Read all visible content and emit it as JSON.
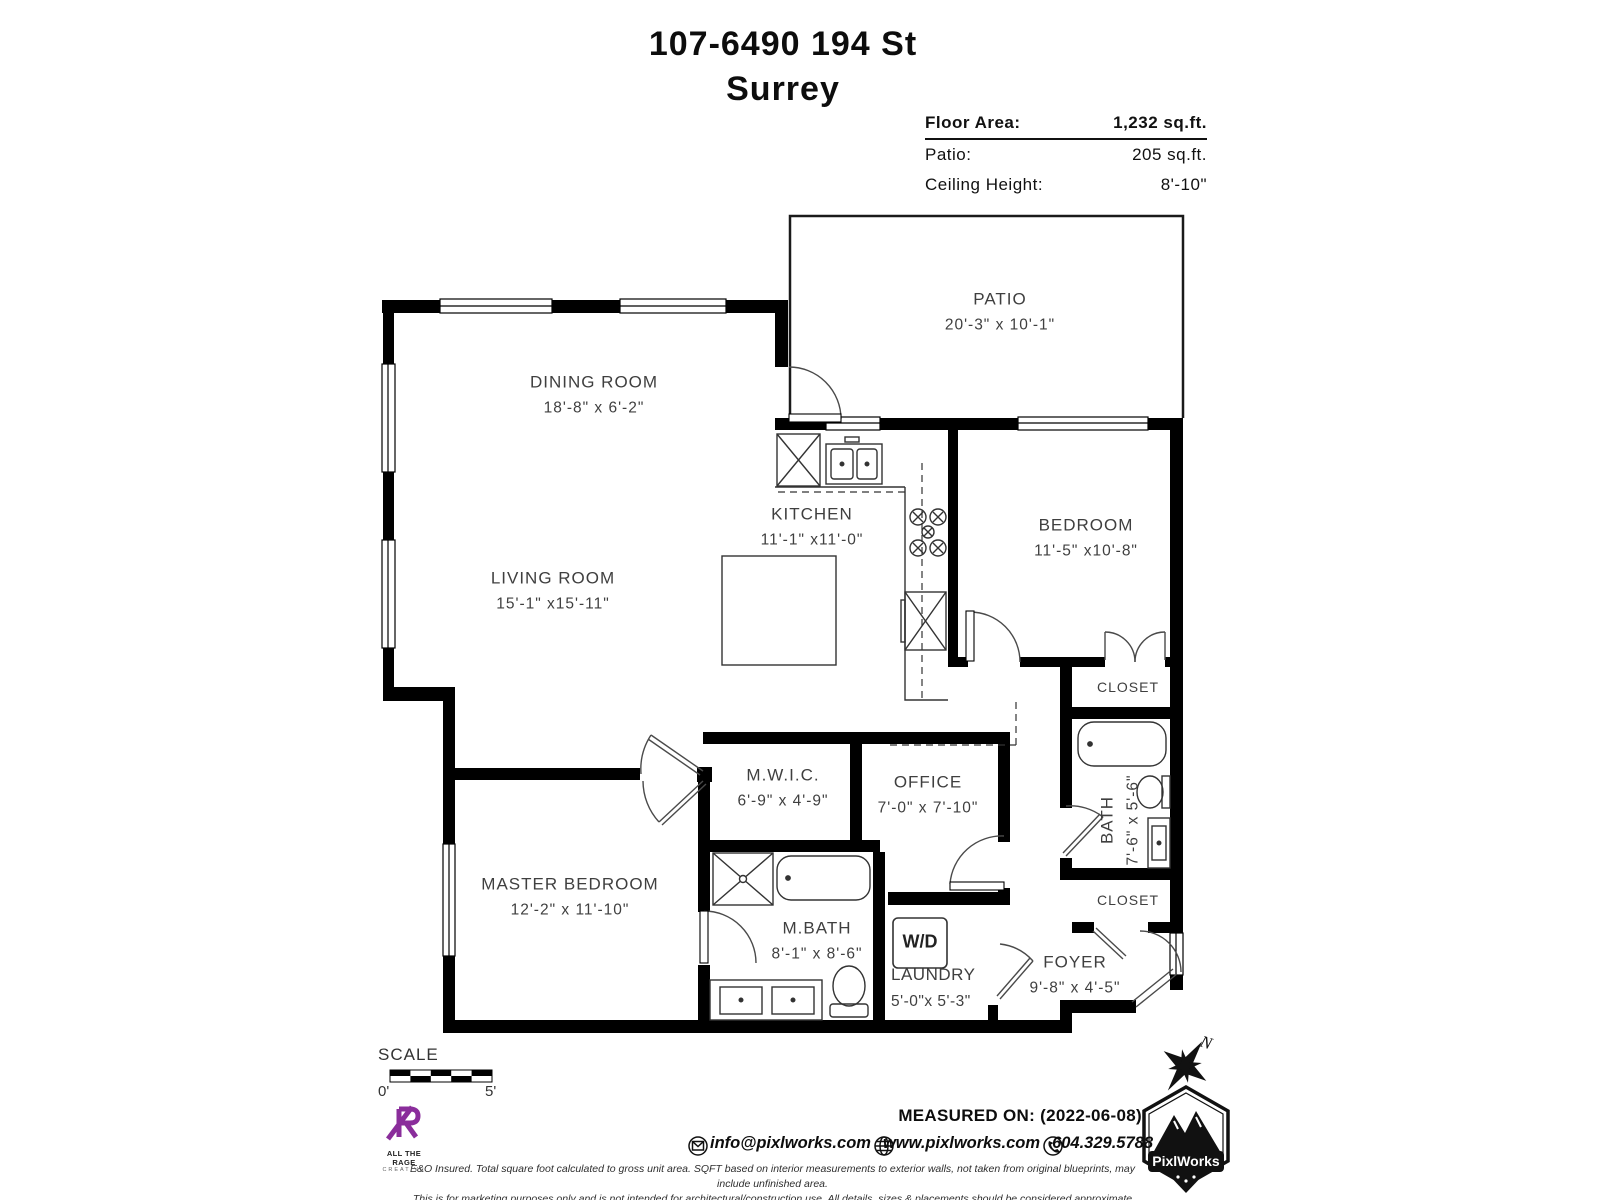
{
  "header": {
    "title_line1": "107-6490 194 St",
    "title_line2": "Surrey"
  },
  "info": {
    "floor_area_label": "Floor Area:",
    "floor_area_value": "1,232 sq.ft.",
    "patio_label": "Patio:",
    "patio_value": "205 sq.ft.",
    "ceiling_label": "Ceiling Height:",
    "ceiling_value": "8'-10\""
  },
  "rooms": {
    "patio": {
      "name": "PATIO",
      "dims": "20'-3\" x 10'-1\""
    },
    "dining": {
      "name": "DINING ROOM",
      "dims": "18'-8\" x 6'-2\""
    },
    "living": {
      "name": "LIVING ROOM",
      "dims": "15'-1\" x15'-11\""
    },
    "kitchen": {
      "name": "KITCHEN",
      "dims": "11'-1\" x11'-0\""
    },
    "bedroom": {
      "name": "BEDROOM",
      "dims": "11'-5\" x10'-8\""
    },
    "closet1": {
      "name": "CLOSET"
    },
    "bath": {
      "name": "BATH",
      "dims": "7'-6\" x 5'-6\""
    },
    "closet2": {
      "name": "CLOSET"
    },
    "mwic": {
      "name": "M.W.I.C.",
      "dims": "6'-9\" x 4'-9\""
    },
    "office": {
      "name": "OFFICE",
      "dims": "7'-0\" x 7'-10\""
    },
    "master": {
      "name": "MASTER BEDROOM",
      "dims": "12'-2\" x 11'-10\""
    },
    "mbath": {
      "name": "M.BATH",
      "dims": "8'-1\" x 8'-6\""
    },
    "laundry": {
      "name": "LAUNDRY",
      "dims": "5'-0\"x 5'-3\"",
      "wd": "W/D"
    },
    "foyer": {
      "name": "FOYER",
      "dims": "9'-8\" x 4'-5\""
    }
  },
  "scale": {
    "label": "SCALE",
    "start": "0'",
    "end": "5'"
  },
  "compass": {
    "north": "N"
  },
  "footer": {
    "measured_on": "MEASURED ON: (2022-06-08)",
    "email": "info@pixlworks.com",
    "website": "www.pixlworks.com",
    "phone": "604.329.5788",
    "disclaimer1": "E&O Insured.  Total square foot calculated to gross unit area. SQFT based on interior measurements to exterior walls, not taken from original blueprints, may include unfinished area.",
    "disclaimer2": "This is for marketing purposes only and is not intended for architectural/construction use.  All details, sizes & placements should be considered approximate within +/- 2%  tolerance.",
    "brand_name": "PixlWorks",
    "creative_logo_line1": "ALL THE RAGE",
    "creative_logo_line2": "CREATIVE"
  },
  "colors": {
    "wall": "#000000",
    "accent_purple": "#8a2d9b",
    "text": "#3f3f3f"
  }
}
